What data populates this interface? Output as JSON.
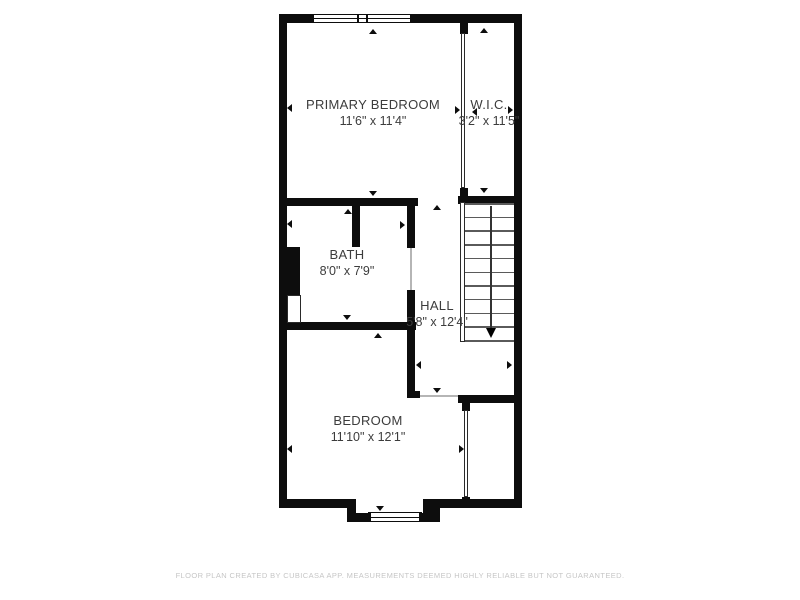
{
  "plan": {
    "rooms": [
      {
        "id": "primary-bedroom",
        "label": "PRIMARY BEDROOM",
        "dimensions": "11'6\" x 11'4\""
      },
      {
        "id": "wic",
        "label": "W.I.C.",
        "dimensions": "3'2\" x 11'5\""
      },
      {
        "id": "bath",
        "label": "BATH",
        "dimensions": "8'0\" x 7'9\""
      },
      {
        "id": "hall",
        "label": "HALL",
        "dimensions": "5'8\" x 12'4\""
      },
      {
        "id": "bedroom",
        "label": "BEDROOM",
        "dimensions": "11'10\" x 12'1\""
      }
    ],
    "stairs": {
      "tread_count": 11,
      "direction": "down"
    },
    "icons": {
      "stairs_direction_arrow": "down-triangle",
      "measure_arrow": "small-triangle",
      "window_symbol": "framed-rectangle"
    }
  },
  "footer": {
    "disclaimer": "FLOOR PLAN CREATED BY CUBICASA APP. MEASUREMENTS DEEMED HIGHLY RELIABLE BUT NOT GUARANTEED."
  },
  "colors": {
    "wall": "#0d0d0d",
    "background": "#ffffff",
    "label_text": "#3c3c3c",
    "footer_text": "#c6c6c6"
  }
}
